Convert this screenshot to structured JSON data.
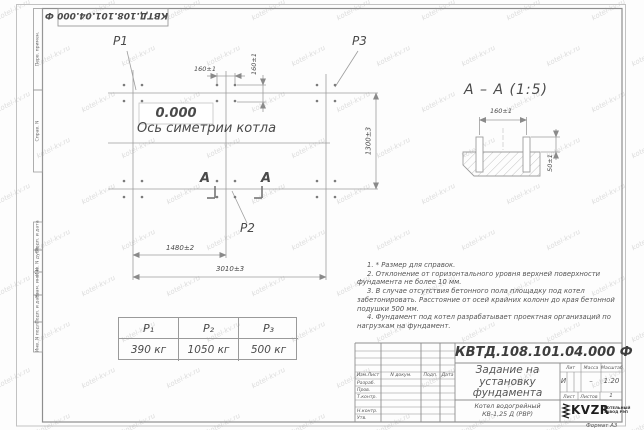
{
  "stamp_top": "КВТД.108.101.04.000 Ф",
  "watermark": {
    "text": "kotel-kv.ru"
  },
  "margin_labels": {
    "perv_primen": "Перв. примен.",
    "sprav_n": "Справ. N",
    "podp_data_1": "Подп. и дата",
    "inv_dubl": "Инв. N дубл.",
    "vzam_inv": "Взам. инв. N",
    "podp_data_2": "Подп. и дата",
    "inv_podl": "Инв. N подл."
  },
  "plan": {
    "p1_label": "P1",
    "p2_label": "P2",
    "p3_label": "P3",
    "elevation": "0.000",
    "axis_label": "Ось симетрии котла",
    "dim_160_h": "160±1",
    "dim_160_v": "160±1",
    "dim_1300": "1300±3",
    "dim_1480": "1480±2",
    "dim_3010": "3010±3",
    "section_letter_left": "А",
    "section_letter_right": "А"
  },
  "section_view": {
    "title": "А – А (1:5)",
    "dim_160": "160±1",
    "dim_50": "50±1"
  },
  "notes": [
    "1. * Размер для справок.",
    "2. Отклонение от горизонтального уровня верхней поверхности фундамента не более 10 мм.",
    "3. В случае отсутствия бетонного пола площадку под котел забетонировать. Расстояние от осей крайних колонн до края бетонной подушки 500 мм.",
    "4. Фундамент под котел разрабатывает проектная организаций по нагрузкам на фундамент."
  ],
  "load_table": {
    "headers": [
      "P₁",
      "P₂",
      "P₃"
    ],
    "values": [
      "390 кг",
      "1050 кг",
      "500 кг"
    ]
  },
  "title_block": {
    "doc_number": "КВТД.108.101.04.000 Ф",
    "title_lines": [
      "Задание на",
      "установку",
      "фундамента"
    ],
    "product_lines": [
      "Котел водогрейный",
      "КВ-1,25 Д (РВР)"
    ],
    "header_cols": [
      "Изм.Лист",
      "N докум.",
      "Подп.",
      "Дата"
    ],
    "rows": [
      "Разраб.",
      "Пров.",
      "Т.контр.",
      "",
      "Н.контр.",
      "Утв."
    ],
    "lit_label": "Лит",
    "massa_label": "Масса",
    "masshtab_label": "Масштаб",
    "lit_value": "И",
    "massa_value": "–",
    "masshtab_value": "1:20",
    "list_label": "Лист",
    "listov_label": "Листов",
    "listov_value": "1",
    "logo_text": "KVZR",
    "logo_sub_1": "КОТЕЛЬНЫЙ",
    "logo_sub_2": "ЗАВОД РЭП",
    "format_label": "Формат А3"
  }
}
